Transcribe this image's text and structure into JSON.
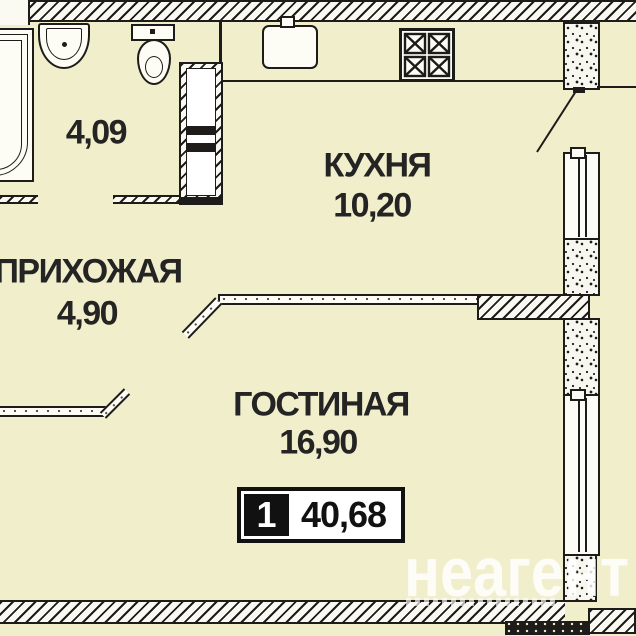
{
  "plan_title": "apartment-floor-plan",
  "rooms": [
    {
      "id": "bathroom",
      "label": "",
      "area": "4,09"
    },
    {
      "id": "hallway",
      "label": "ПРИХОЖАЯ",
      "area": "4,90"
    },
    {
      "id": "kitchen",
      "label": "КУХНЯ",
      "area": "10,20"
    },
    {
      "id": "living",
      "label": "ГОСТИНАЯ",
      "area": "16,90"
    }
  ],
  "summary": {
    "rooms_count": "1",
    "total_area": "40,68"
  },
  "watermark": {
    "text": "неагент"
  },
  "fixtures": [
    "bathtub",
    "washbasin",
    "toilet",
    "kitchen-sink",
    "stove",
    "ventilation-shaft",
    "entry-door",
    "windows"
  ],
  "colors": {
    "background": "#f1eecb",
    "line": "#1d1c1a",
    "text": "#242424",
    "badge_black": "#111111",
    "watermark": "#ffffff"
  }
}
